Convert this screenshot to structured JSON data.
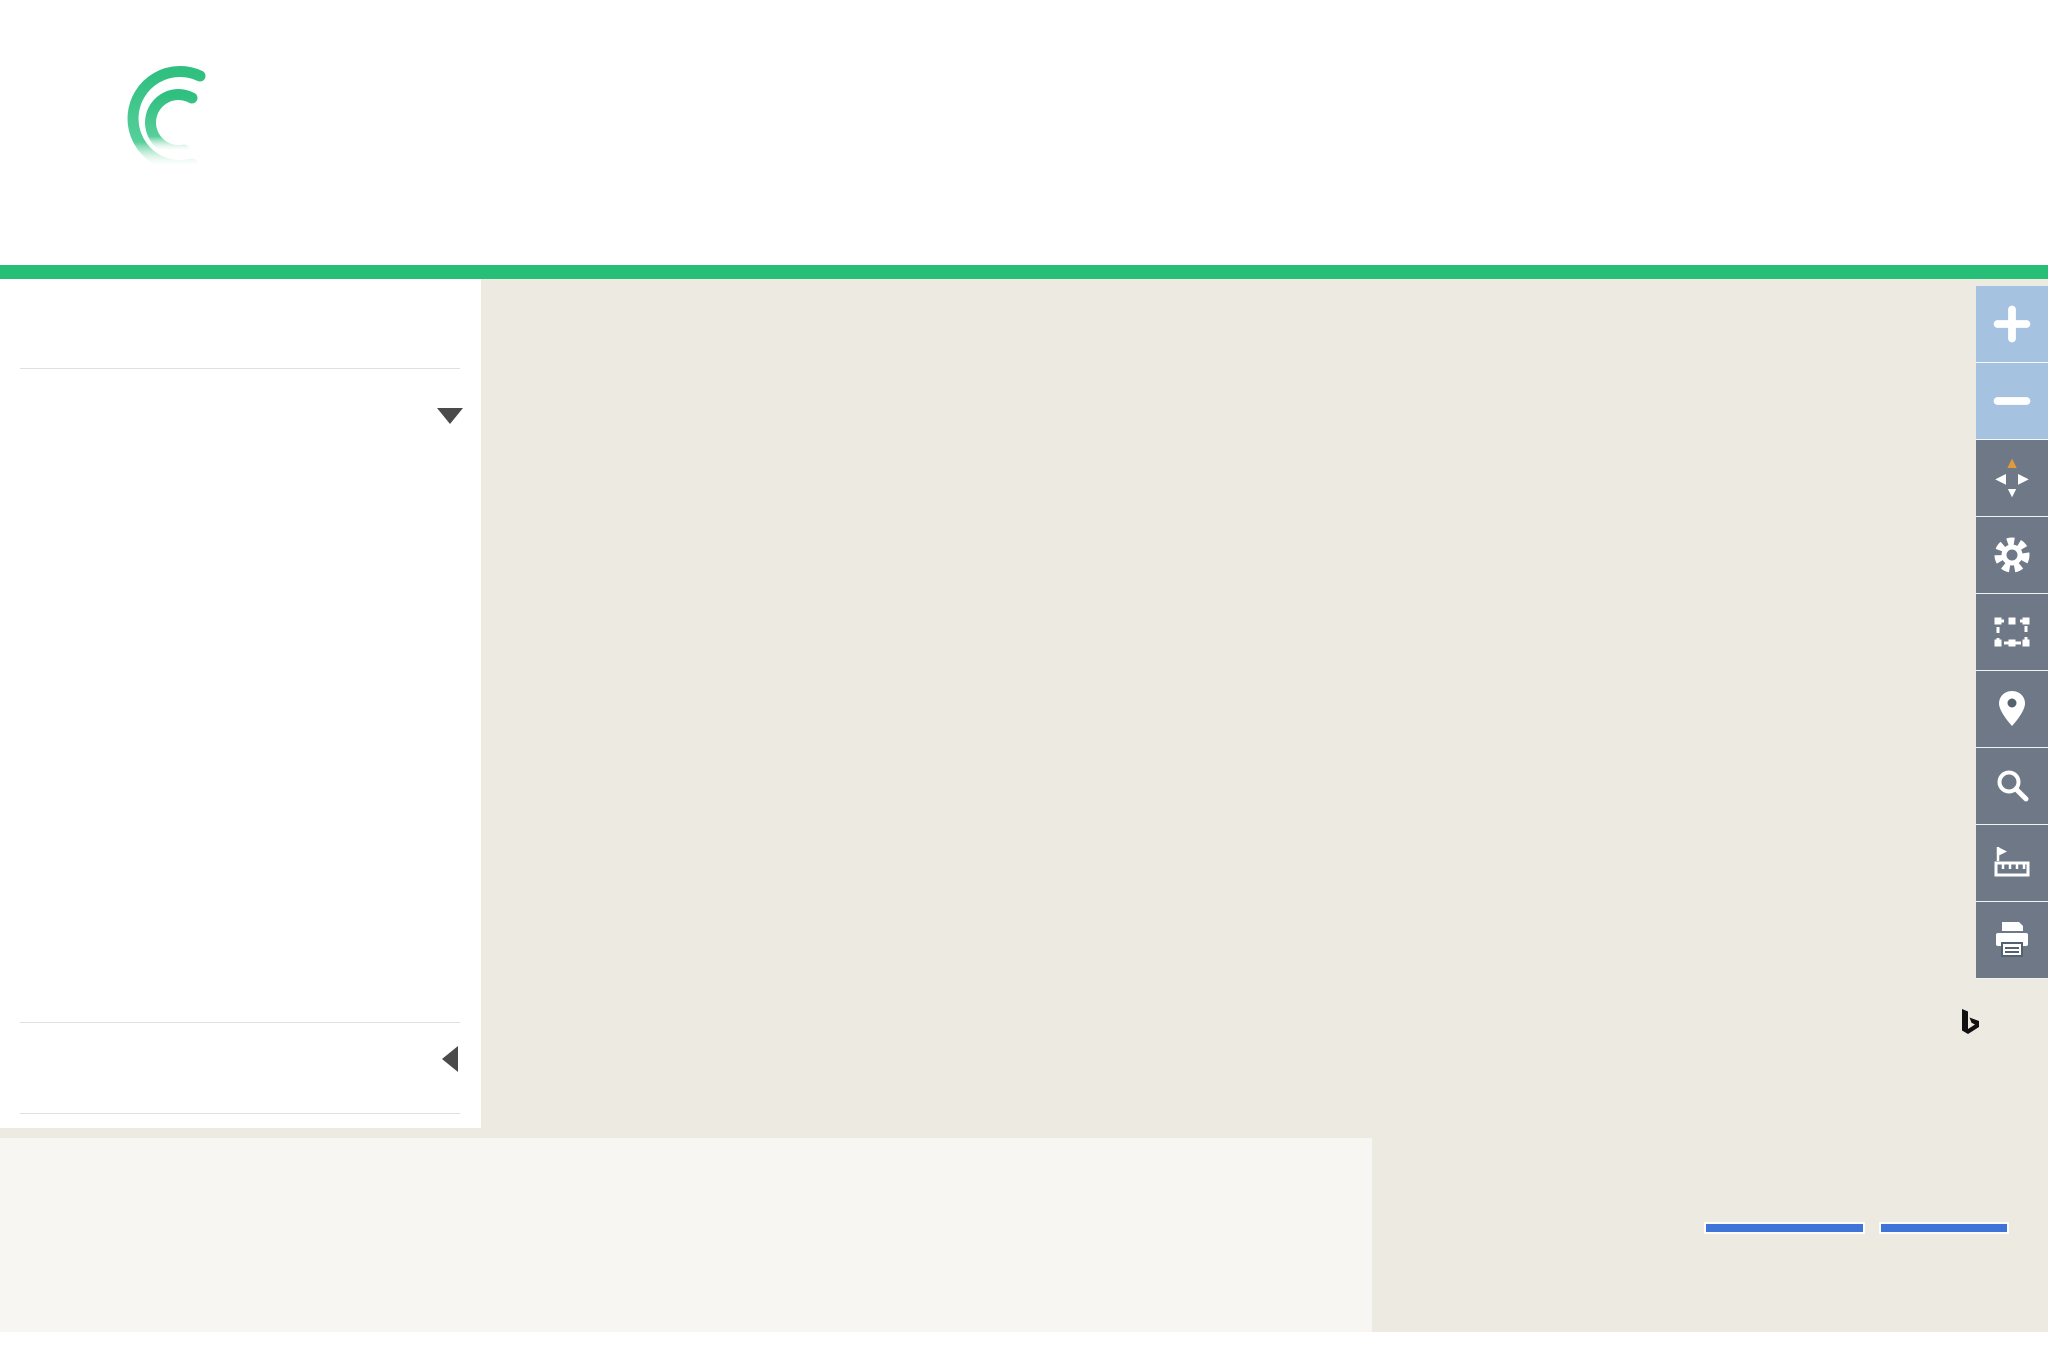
{
  "header": {
    "logo_text_bold": "Local",
    "logo_text_light": "Look",
    "nav": [
      {
        "label": "« BACK TO PROPERTY REPORT"
      },
      {
        "label": "PROFILE & SETTINGS"
      },
      {
        "label": "HELP"
      }
    ],
    "address_label": "Map for Parcel Address:",
    "address_value": "9304 Briarwood Blvd Knoxville, TN 37923-2156",
    "parcel_id_label": "Parcel ID:",
    "parcel_id_value": "119AE017"
  },
  "sidebar": {
    "parcels_label": "PARCELS",
    "parcels_state": "ON",
    "recent_sales_label": "RECENT SALES",
    "items": [
      {
        "label": "Last 3 Months",
        "state": "OFF"
      },
      {
        "label": "Last 6 Months",
        "state": "OFF"
      },
      {
        "label": "Last 9 Months",
        "state": "ON"
      },
      {
        "label": "Last 12 Months",
        "state": "OFF"
      },
      {
        "label": "Last 18 Months",
        "state": "OFF"
      },
      {
        "label": "Last 24 Months",
        "state": "OFF"
      },
      {
        "label": "Last 36 Months",
        "state": "OFF"
      },
      {
        "label": "Last 48 Months",
        "state": "OFF"
      },
      {
        "label": "Last 60 Months",
        "state": "OFF"
      }
    ],
    "labels_label": "LABELS"
  },
  "toggle": {
    "on": "ON",
    "off": "OFF"
  },
  "legend": {
    "recent_sales_title": "Recent Sales - Since 6/9/2019",
    "sales": [
      {
        "label": "< $100,000",
        "color": "#c00008"
      },
      {
        "label": "$100,000 to $149,999",
        "color": "#e9e839"
      },
      {
        "label": "$150,000 to $199,999",
        "color": "#7cc42d"
      },
      {
        "label": "$200,000 to $279,999",
        "color": "#4d9cb9"
      },
      {
        "label": "$280,000 +",
        "color": "#7559a5"
      }
    ],
    "fema_title": "FEMA Flood Zones",
    "fema": [
      {
        "label": "Effective High-Risk Areas (SFHA)",
        "color": "#00918f"
      },
      {
        "label": "Effective Moderate-Risk Areas",
        "color": "#00ffff"
      },
      {
        "label": "Effective Undetermined-Risk Areas",
        "color": "#a9f2f7"
      },
      {
        "label": "Preliminary High-Risk Areas (SFHA)",
        "color": "#7c3f9d"
      },
      {
        "label": "Preliminary Moderate-Risk Areas",
        "color": "#b282cd"
      },
      {
        "label": "Preliminary Undetermined-Risk Areas",
        "color": "#ddd1eb"
      }
    ]
  },
  "map": {
    "route_number": "169",
    "compass_n": "N",
    "scale_feet": "1000 feet",
    "scale_meters": "250 m",
    "attribution_line1": "© 2020 HERE, © 2020 Microsoft Corporation",
    "attribution_line2a": "© 2020 Courthouse Retrieval System. All Rights Reserved. ",
    "attribution_line2b": "Information",
    "attribution_line3a": "Deemed Reliable But Not Guaranteed.",
    "attribution_line3b": " © OpenStreetMap",
    "terms_label": "Terms",
    "bing_label": "Bing",
    "place_labels": [
      {
        "lines": [
          "Hidden",
          "Valley"
        ],
        "x": 1452,
        "y": 612,
        "s": 36
      },
      {
        "lines": [
          "West"
        ],
        "x": 528,
        "y": 848,
        "s": 36
      },
      {
        "lines": [
          "Gulfwood"
        ],
        "x": 1432,
        "y": 1133,
        "s": 34
      },
      {
        "lines": [
          "Crestwood Hills"
        ],
        "x": 1824,
        "y": 1189,
        "s": 32
      }
    ],
    "shields": [
      {
        "x": 1400,
        "y": 427
      },
      {
        "x": 1289,
        "y": 468
      }
    ],
    "blue_markers": [
      {
        "x": 858,
        "y": 878,
        "r": -24
      },
      {
        "x": 884,
        "y": 862,
        "r": -8
      }
    ],
    "road_labels": [
      {
        "text": "Turnberry Dr",
        "x": 542,
        "y": 520,
        "r": -64
      },
      {
        "text": "Durham Rd",
        "x": 596,
        "y": 442,
        "r": 78
      },
      {
        "text": "Middlebrook Pike",
        "x": 836,
        "y": 466,
        "r": 56,
        "s": 26
      },
      {
        "text": "Middlebrook Pike NW",
        "x": 1118,
        "y": 664,
        "r": -12,
        "s": 26
      },
      {
        "text": "Middlebrook Pike NW",
        "x": 1555,
        "y": 346,
        "r": -23,
        "s": 26
      },
      {
        "text": "Bob Gray Rd",
        "x": 812,
        "y": 622,
        "r": 9,
        "s": 25
      },
      {
        "text": "Folkstone Pl",
        "x": 978,
        "y": 390,
        "r": 74
      },
      {
        "text": "Tall Timber Dr",
        "x": 1076,
        "y": 342,
        "r": 48
      },
      {
        "text": "Fairhaven Pl",
        "x": 1135,
        "y": 336,
        "r": 58
      },
      {
        "text": "Wallingford Rd",
        "x": 1328,
        "y": 396,
        "r": -78
      },
      {
        "text": "Chert Pit Rd",
        "x": 1382,
        "y": 392,
        "r": -78
      },
      {
        "text": "Foxcroft Dr",
        "x": 1448,
        "y": 360,
        "r": -60
      },
      {
        "text": "Parrish Rd",
        "x": 1660,
        "y": 443,
        "r": -79
      },
      {
        "text": "Parrish Rd",
        "x": 1648,
        "y": 605,
        "r": -80
      },
      {
        "text": "Corning Rd",
        "x": 1740,
        "y": 449,
        "r": -76
      },
      {
        "text": "Corning Rd",
        "x": 1723,
        "y": 583,
        "r": -70
      },
      {
        "text": "Remington Dr",
        "x": 1778,
        "y": 470,
        "r": -85
      },
      {
        "text": "Roderick Rd",
        "x": 1832,
        "y": 488,
        "r": -68
      },
      {
        "text": "Fox Lonas Rd",
        "x": 1868,
        "y": 438,
        "r": -78
      },
      {
        "text": "Farmington",
        "x": 1938,
        "y": 688,
        "r": -8
      },
      {
        "text": "Chateaugay Rd",
        "x": 620,
        "y": 778,
        "r": 66
      },
      {
        "text": "Needles Dr",
        "x": 722,
        "y": 750,
        "r": 22
      },
      {
        "text": "Whirlaway Circle",
        "x": 762,
        "y": 848,
        "r": -78
      },
      {
        "text": "Swaps Ln",
        "x": 697,
        "y": 940,
        "r": -80
      },
      {
        "text": "Ponder Rd",
        "x": 908,
        "y": 786,
        "r": 80
      },
      {
        "text": "N Cedar Bluff Rd",
        "x": 967,
        "y": 775,
        "r": 87,
        "s": 24
      },
      {
        "text": "Briarwood Dr",
        "x": 592,
        "y": 1050,
        "r": 7
      },
      {
        "text": "Park Dr",
        "x": 408,
        "y": 1133,
        "r": 8
      },
      {
        "text": "Hidden Valley Rd",
        "x": 1387,
        "y": 700,
        "r": -63
      },
      {
        "text": "Sunnydale Rd",
        "x": 1122,
        "y": 722,
        "r": -74
      },
      {
        "text": "Sunnydale Rd",
        "x": 1350,
        "y": 966,
        "r": -72
      },
      {
        "text": "Gulfwood Rd",
        "x": 1173,
        "y": 722,
        "r": -78
      },
      {
        "text": "Gulfwood Rd",
        "x": 1252,
        "y": 964,
        "r": -84
      },
      {
        "text": "Candlewood Dr",
        "x": 1383,
        "y": 803,
        "r": -60
      },
      {
        "text": "Plainfield Rd",
        "x": 1338,
        "y": 827,
        "r": -79
      },
      {
        "text": "Owl Hollow Rd",
        "x": 1458,
        "y": 758,
        "r": -84
      },
      {
        "text": "Sky-Blue Dr",
        "x": 1537,
        "y": 640,
        "r": -74
      },
      {
        "text": "Crest-Forest Rd",
        "x": 1523,
        "y": 725,
        "r": -82
      },
      {
        "text": "Farne Island Blvd",
        "x": 1570,
        "y": 598,
        "r": -54,
        "s": 25
      },
      {
        "text": "Fernwood Rd",
        "x": 1290,
        "y": 1032,
        "r": -74
      },
      {
        "text": "Belle Glade Ln",
        "x": 1438,
        "y": 968,
        "r": 12
      },
      {
        "text": "Ormand Ln",
        "x": 1462,
        "y": 906,
        "r": 12
      },
      {
        "text": "Dorset Dr",
        "x": 1594,
        "y": 772,
        "r": -84
      },
      {
        "text": "Fox Lonas Rd",
        "x": 1624,
        "y": 866,
        "r": -84
      },
      {
        "text": "Leyton Dr",
        "x": 1745,
        "y": 753,
        "r": 7
      },
      {
        "text": "Walker Springs Rd",
        "x": 1944,
        "y": 1012,
        "r": -55
      },
      {
        "text": "Fox Lake Dr",
        "x": 1550,
        "y": 1160,
        "r": 36
      },
      {
        "text": "Coventry Rd",
        "x": 1828,
        "y": 1082,
        "r": -72
      },
      {
        "text": "Schenley Rd",
        "x": 1972,
        "y": 1105,
        "r": -62
      },
      {
        "text": "E Meadecrest Dr",
        "x": 2020,
        "y": 1170,
        "r": -68
      },
      {
        "text": "Mobile Dr",
        "x": 552,
        "y": 1182,
        "r": 9
      },
      {
        "text": "Sarasota Dr",
        "x": 718,
        "y": 1266,
        "r": 4
      },
      {
        "text": "Tallahassee Ln",
        "x": 282,
        "y": 1284,
        "r": 7
      },
      {
        "text": "Naples Rd",
        "x": 323,
        "y": 1216,
        "r": -84
      },
      {
        "text": "Pensacola Rd",
        "x": 851,
        "y": 1256,
        "r": -86
      },
      {
        "text": "Countryside",
        "x": 1444,
        "y": 1334,
        "r": -10
      },
      {
        "text": "Cross Creek Rd",
        "x": 1545,
        "y": 1295,
        "r": -68
      }
    ]
  }
}
